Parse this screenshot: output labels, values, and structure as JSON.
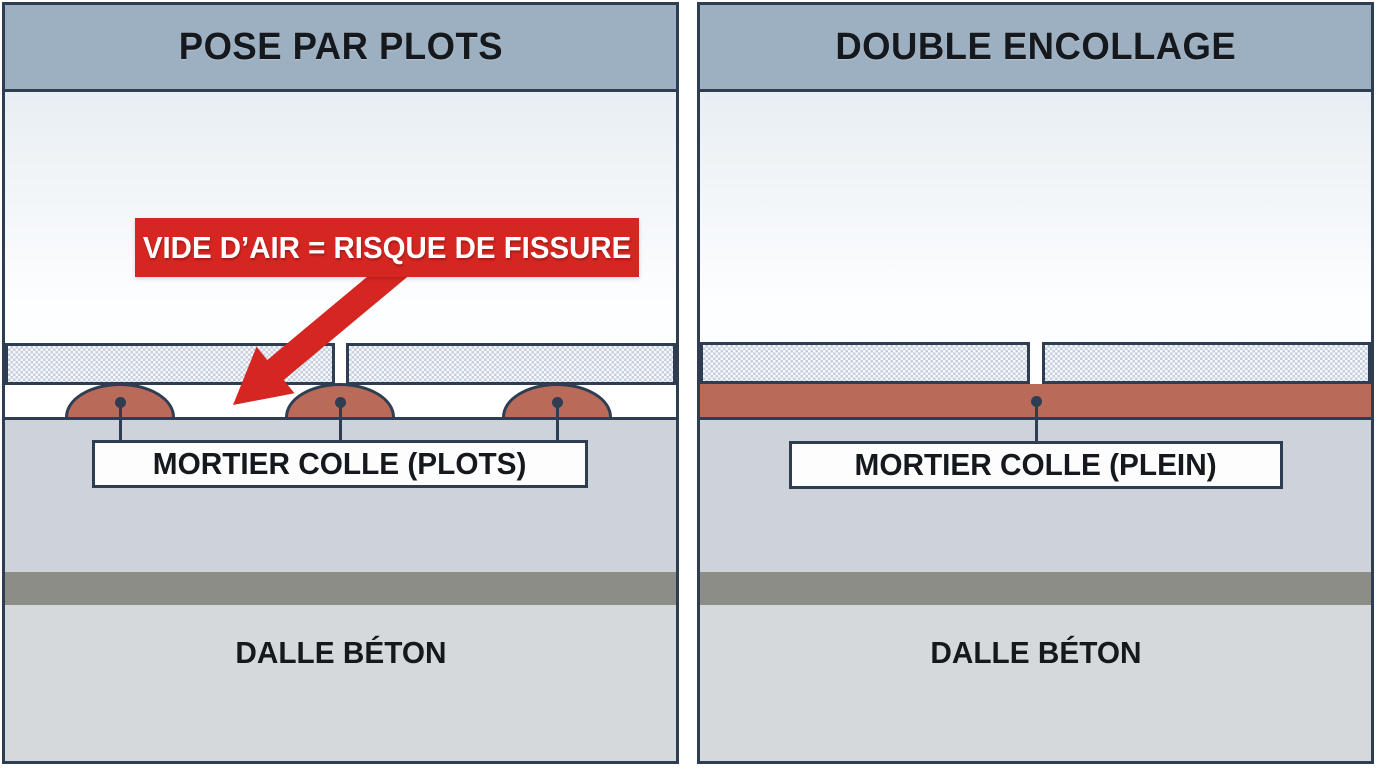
{
  "colors": {
    "border": "#2e3d51",
    "header_bg": "#9db0c2",
    "sky_top": "#e8eef3",
    "sky_bottom": "#fdfeff",
    "tile_bg": "#f7f9fc",
    "tile_check": "#c5cfdd",
    "mortar": "#b96a58",
    "substrate": "#cdd3d8",
    "dark_band": "#8d8d88",
    "slab": "#d5d9db",
    "banner_bg": "#d62621",
    "banner_text": "#ffffff",
    "label_box_bg": "#fdfdfd",
    "text_dark": "#15191e"
  },
  "left_panel": {
    "title": "POSE PAR PLOTS",
    "warning": "VIDE D’AIR = RISQUE DE FISSURE",
    "mortar_label": "MORTIER COLLE (PLOTS)",
    "slab_label": "DALLE BÉTON"
  },
  "right_panel": {
    "title": "DOUBLE ENCOLLAGE",
    "mortar_label": "MORTIER COLLE (PLEIN)",
    "slab_label": "DALLE BÉTON"
  }
}
